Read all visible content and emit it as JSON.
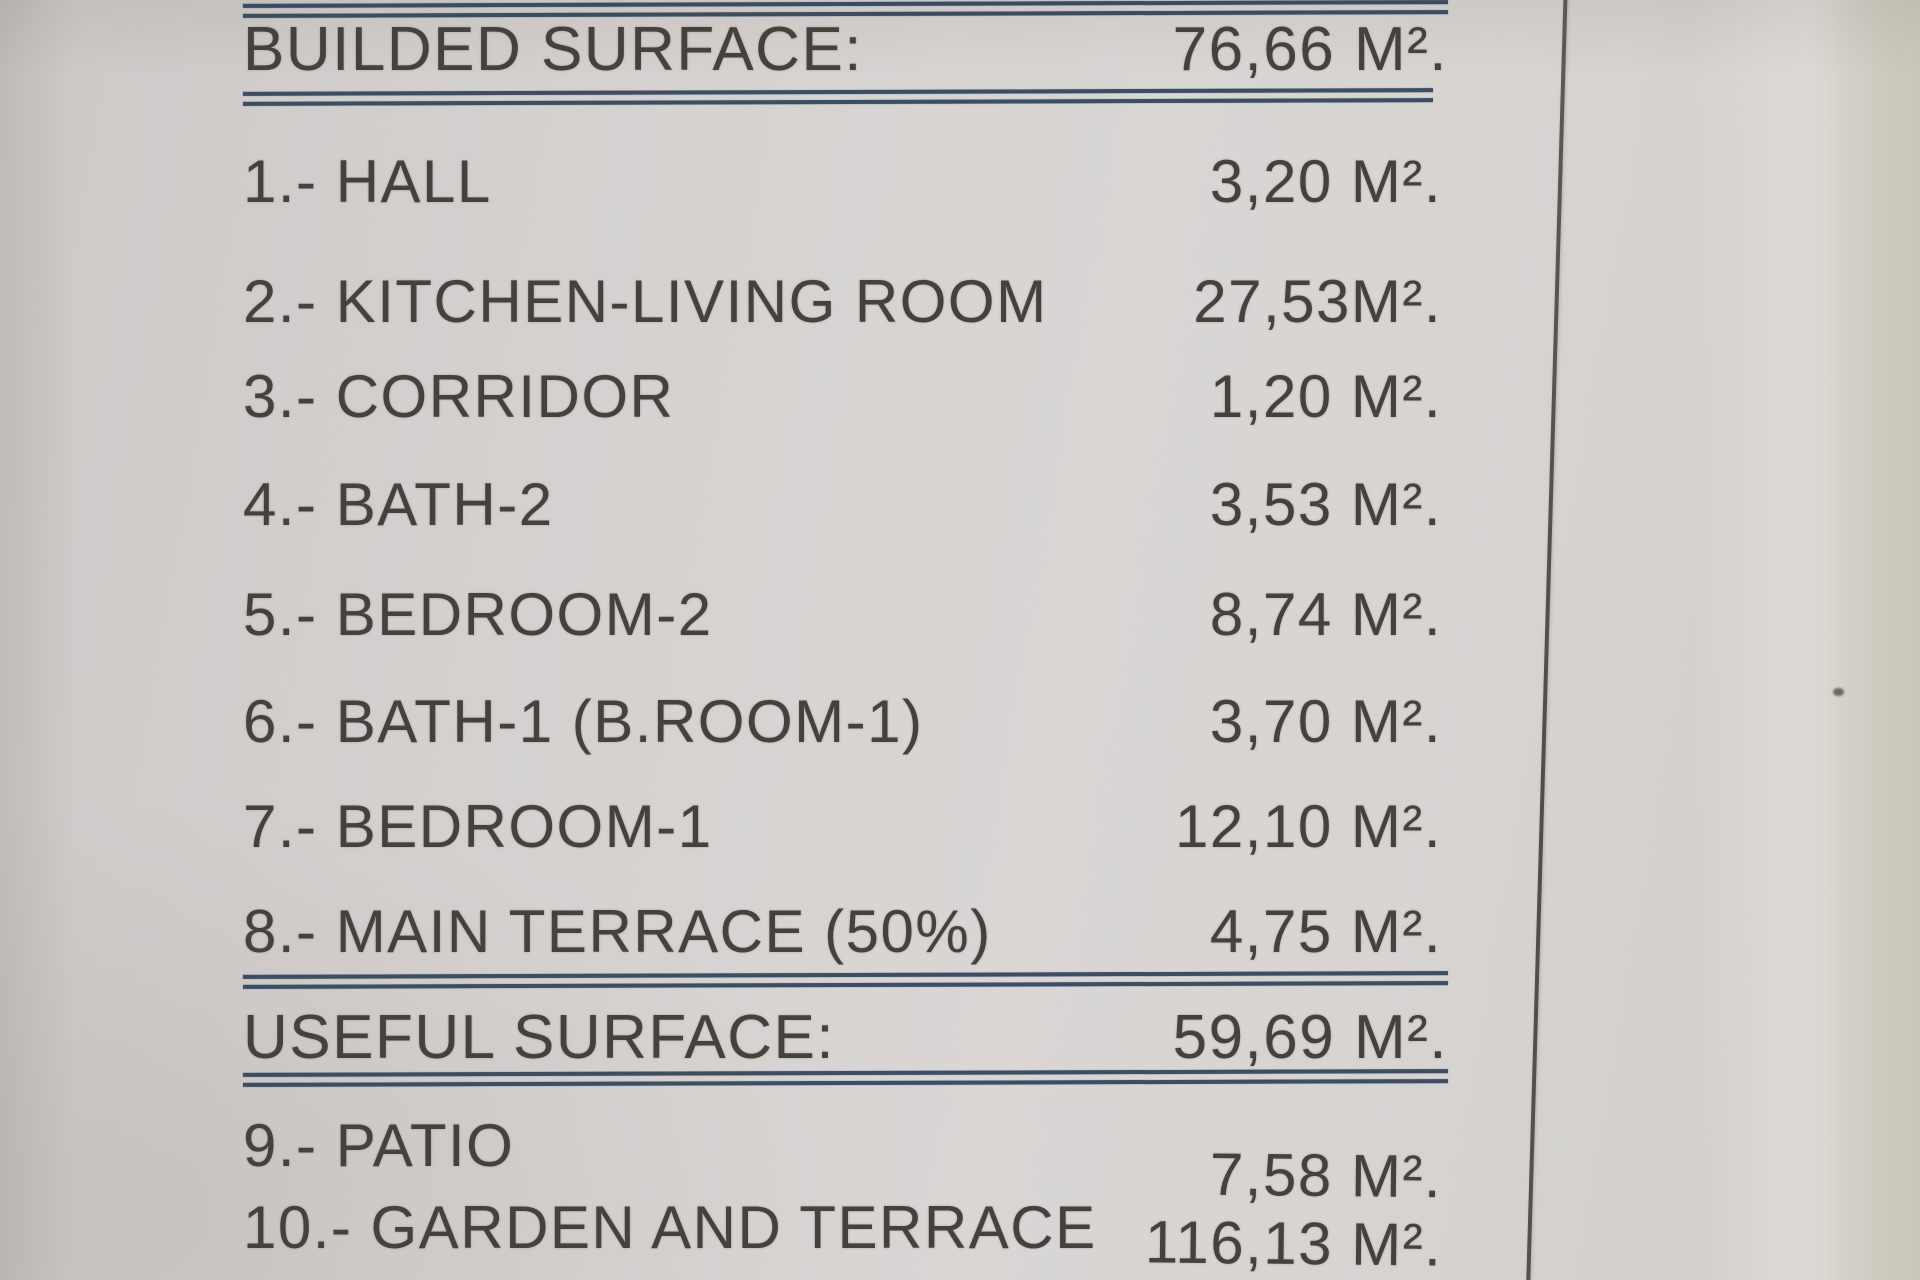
{
  "document": {
    "type": "surface-area-schedule",
    "colors": {
      "paper": "#d6d3d1",
      "rule_blue": "#3c4e63",
      "text": "#45423e",
      "background_right": "#c9c8bb",
      "fold_line": "#55514c"
    },
    "sections": [
      {
        "header": {
          "label": "BUILDED SURFACE:",
          "value": "76,66 M²."
        },
        "rows": [
          {
            "label": "1.- HALL",
            "value": "3,20 M²."
          },
          {
            "label": "2.- KITCHEN-LIVING ROOM",
            "value": "27,53M²."
          },
          {
            "label": "3.- CORRIDOR",
            "value": "1,20 M²."
          },
          {
            "label": "4.- BATH-2",
            "value": "3,53 M²."
          },
          {
            "label": "5.- BEDROOM-2",
            "value": "8,74 M²."
          },
          {
            "label": "6.- BATH-1 (B.ROOM-1)",
            "value": "3,70 M²."
          },
          {
            "label": "7.- BEDROOM-1",
            "value": "12,10 M²."
          },
          {
            "label": "8.- MAIN TERRACE (50%)",
            "value": "4,75 M²."
          }
        ]
      },
      {
        "header": {
          "label": "USEFUL SURFACE:",
          "value": "59,69 M²."
        },
        "rows": [
          {
            "label": "9.- PATIO",
            "value": "7,58 M²."
          },
          {
            "label": "10.- GARDEN AND TERRACE",
            "value": "116,13 M²."
          }
        ]
      }
    ]
  }
}
